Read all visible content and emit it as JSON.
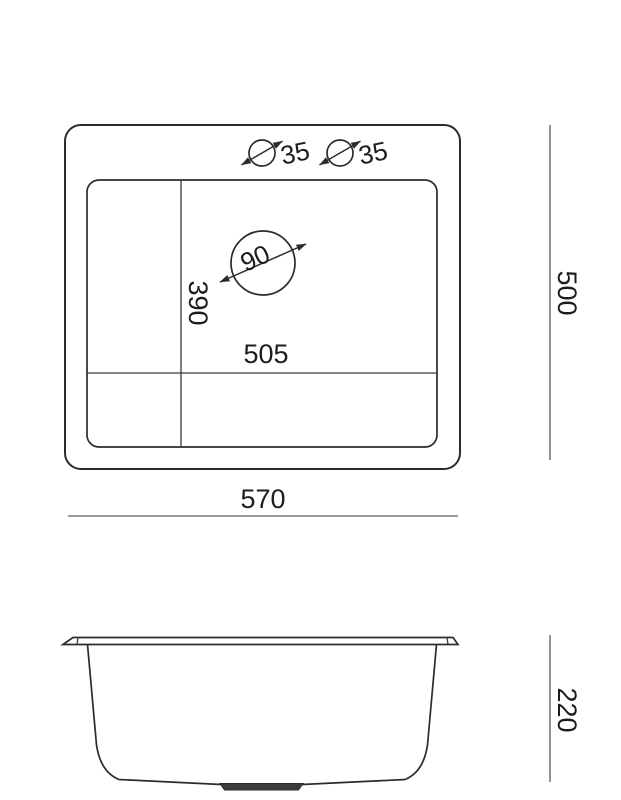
{
  "page": {
    "background_color": "#ffffff"
  },
  "drawing": {
    "kind": "sink-technical-dimension-drawing",
    "views": [
      "top-view",
      "side-view"
    ],
    "colors": {
      "outline": "#2c2c2c",
      "dimension_line": "#7a7a7a",
      "text": "#1d1d1d",
      "drain_fill": "#3c3c3c"
    },
    "top_view": {
      "faucet_hole_1": {
        "diameter_label": "35"
      },
      "faucet_hole_2": {
        "diameter_label": "35"
      },
      "drain_hole": {
        "diameter_label": "90"
      },
      "bowl_width_label": "505",
      "bowl_depth_label": "390"
    },
    "dimensions": {
      "overall_width_label": "570",
      "overall_depth_label": "500",
      "bowl_height_label": "220"
    }
  }
}
